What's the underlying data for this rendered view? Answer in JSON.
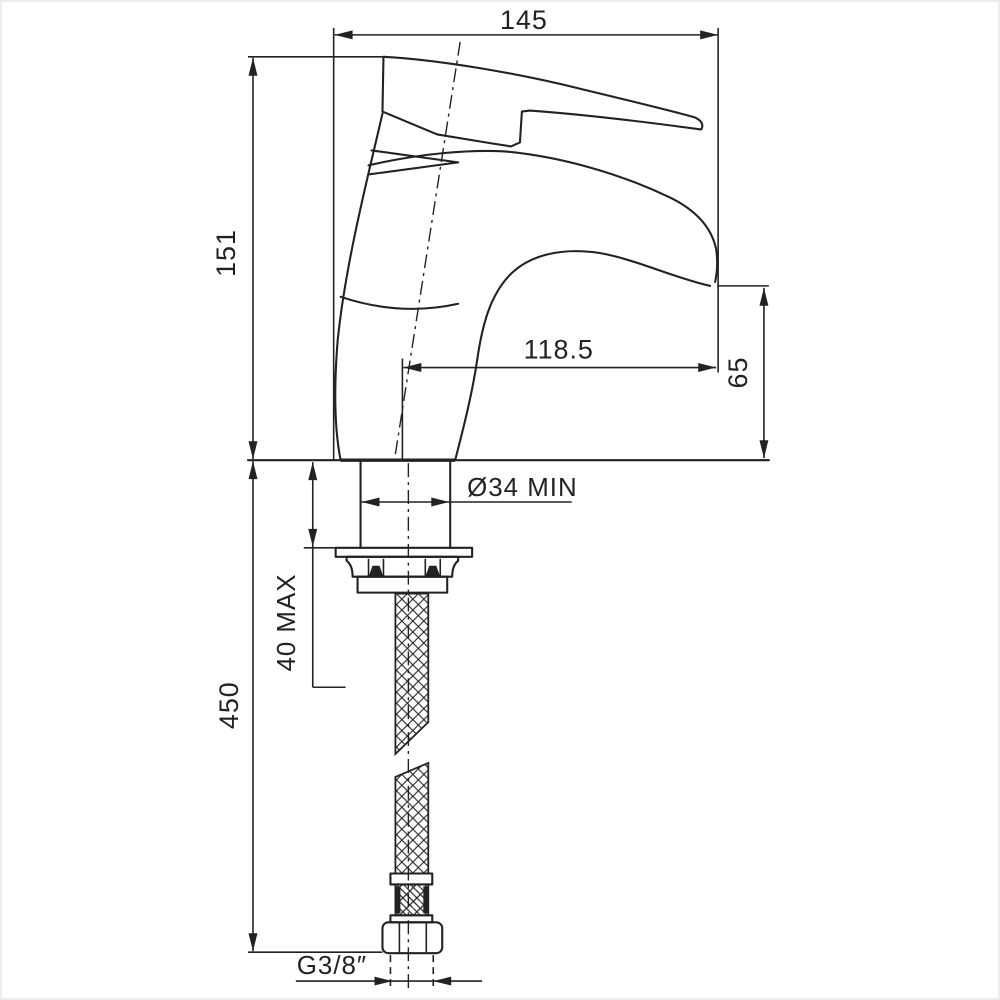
{
  "drawing": {
    "type": "technical-dimension-drawing",
    "subject": "single-lever basin mixer faucet, side view with flexible supply hose",
    "colors": {
      "line": "#222222",
      "background": "#ffffff",
      "border": "#ededed"
    },
    "dims": {
      "top_width": "145",
      "body_height": "151",
      "spout_reach": "118.5",
      "spout_height": "65",
      "hole_diameter": "Ø34 MIN",
      "deck_thickness": "40 MAX",
      "hose_length": "450",
      "thread": "G3/8″"
    }
  }
}
